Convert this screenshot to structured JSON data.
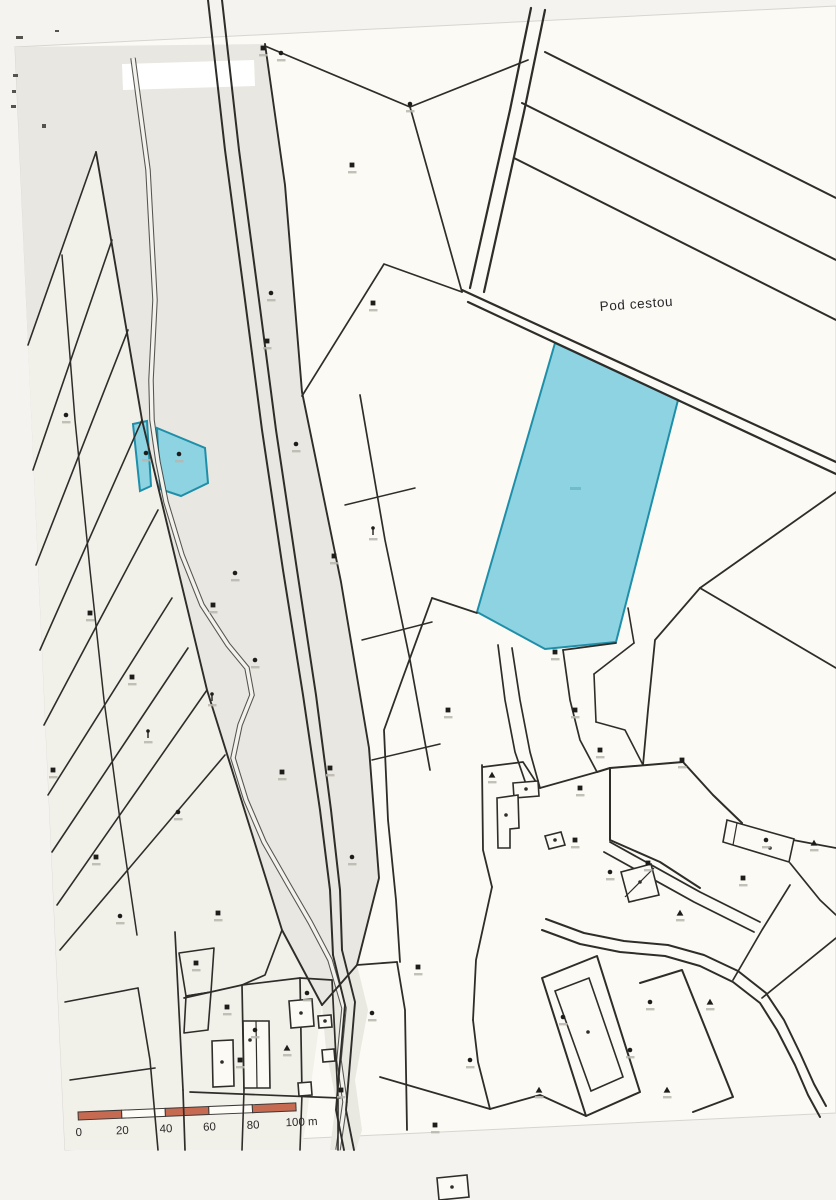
{
  "page": {
    "background": "#f4f3ef",
    "paper_color": "#fbfaf4",
    "paper_edge_color": "#d6d5cf",
    "paper_outline": "M15,47 L836,6 L836,1113 L65,1150 Z"
  },
  "labels": {
    "area_name": "Pod cestou"
  },
  "scale_bar": {
    "labels": [
      "0",
      "20",
      "40",
      "60",
      "80"
    ],
    "end_label": "100 m",
    "segments": 5,
    "segment_px": 43.6,
    "bar_height": 8,
    "bar_color": "#c76a52",
    "alt_color": "#fdfcf7",
    "outline_color": "#3a3937",
    "x": 78,
    "y": 1112,
    "rotation": -2.4
  },
  "map": {
    "line_color": "#2e2d29",
    "highlight_color": "#8ed3e1",
    "highlight_stroke": "#1f8fa9",
    "stream_edge": "#3a3a36",
    "stream_core": "#f3f2ec",
    "regions": [
      {
        "name": "shaded-corridor",
        "fill": "#e8e7e1",
        "d": "M15,47 L265,44 L285,185 L302,392 L341,582 L369,748 L379,878 L357,965 L322,1005 L282,930 L207,690 L142,420 L96,152 L28,345 Z"
      },
      {
        "name": "shaded-left-strips",
        "fill": "#f1f0e9",
        "d": "M28,345 L96,152 L142,420 L207,690 L282,930 L322,1005 L302,1150 L65,1150 Z"
      },
      {
        "name": "shaded-lower-corridor",
        "fill": "#e9e8e1",
        "d": "M322,1005 L357,965 L368,1010 L355,1080 L362,1130 L356,1150 L330,1150 L336,1100 L326,1050 Z"
      },
      {
        "name": "whiteout-patch",
        "fill": "#ffffff",
        "d": "M122,64 L254,60 L255,86 L123,90 Z"
      }
    ],
    "highlight_parcels": [
      {
        "name": "highlighted-parcel-large",
        "d": "M555,343 L678,400 L616,642 L545,649 L477,612 Z"
      },
      {
        "name": "highlighted-parcel-small-left",
        "d": "M133,424 L147,421 L151,486 L140,491 Z"
      },
      {
        "name": "highlighted-parcel-small-right",
        "d": "M157,428 L205,448 L208,483 L181,496 L160,489 Z"
      }
    ],
    "stream_path": "M133,58 L148,170 L155,300 L151,380 L152,420 L158,462 L166,502 L182,555 L202,605 L228,645 L247,668 L252,695 L240,725 L233,758 L246,800 L264,842 L288,884 L310,922 L330,960 L344,1008 L339,1060 L345,1102 L338,1150",
    "lines": [
      {
        "d": "M545,52 L836,198",
        "w": 2
      },
      {
        "d": "M522,103 L836,260",
        "w": 2
      },
      {
        "d": "M514,158 L836,320",
        "w": 2
      },
      {
        "d": "M531,8 L510,110 L470,288",
        "w": 2.2
      },
      {
        "d": "M545,10 L524,112 L484,292",
        "w": 2.2
      },
      {
        "d": "M462,290 L836,462",
        "w": 2.2
      },
      {
        "d": "M468,302 L836,474",
        "w": 2.2
      },
      {
        "d": "M265,46 L410,107",
        "w": 1.7
      },
      {
        "d": "M410,107 L462,292",
        "w": 1.7
      },
      {
        "d": "M410,107 L528,60",
        "w": 1.7
      },
      {
        "d": "M265,44 L285,185 L302,392 L341,582 L369,748 L379,878 L357,965 L322,1005",
        "w": 1.9
      },
      {
        "d": "M96,152 L142,420 L207,690 L282,930 L322,1005",
        "w": 1.9
      },
      {
        "d": "M96,152 L28,345",
        "w": 1.6
      },
      {
        "d": "M112,240 L33,470",
        "w": 1.6
      },
      {
        "d": "M128,330 L36,565",
        "w": 1.6
      },
      {
        "d": "M142,420 L40,650",
        "w": 1.6
      },
      {
        "d": "M158,510 L44,725",
        "w": 1.6
      },
      {
        "d": "M172,598 L48,795",
        "w": 1.6
      },
      {
        "d": "M188,648 L52,852",
        "w": 1.6
      },
      {
        "d": "M207,690 L57,905",
        "w": 1.6
      },
      {
        "d": "M225,755 L60,950",
        "w": 1.6
      },
      {
        "d": "M62,255 L75,420 L90,570 L104,700 L120,820 L137,935",
        "w": 1.5
      },
      {
        "d": "M208,0 L225,150 L245,300 L262,430 L283,570 L303,695 L320,810 L330,890 L333,955",
        "w": 2
      },
      {
        "d": "M222,0 L239,150 L259,300 L276,430 L297,570 L316,695 L331,810 L340,890 L342,950",
        "w": 2
      },
      {
        "d": "M302,396 L384,264 L462,292",
        "w": 1.7
      },
      {
        "d": "M360,395 L385,540 L410,660 L430,770",
        "w": 1.7
      },
      {
        "d": "M345,505 L415,488",
        "w": 1.5
      },
      {
        "d": "M362,640 L432,622",
        "w": 1.5
      },
      {
        "d": "M372,760 L440,744",
        "w": 1.5
      },
      {
        "d": "M432,598 L402,680 L384,730 L388,820 L396,900 L400,962",
        "w": 1.8
      },
      {
        "d": "M477,613 L432,598",
        "w": 1.8
      },
      {
        "d": "M616,643 L563,650",
        "w": 1.8
      },
      {
        "d": "M498,645 L505,700 L515,752 L528,790",
        "w": 1.7
      },
      {
        "d": "M512,648 L520,700 L530,752 L540,788",
        "w": 1.7
      },
      {
        "d": "M563,650 L570,700 L580,740 L597,772",
        "w": 1.7
      },
      {
        "d": "M628,608 L634,643",
        "w": 1.6
      },
      {
        "d": "M634,643 L594,674",
        "w": 1.6
      },
      {
        "d": "M594,674 L596,722",
        "w": 1.6
      },
      {
        "d": "M596,722 L625,730 L643,765",
        "w": 1.6
      },
      {
        "d": "M836,492 L700,588",
        "w": 1.8
      },
      {
        "d": "M700,588 L836,668",
        "w": 1.8
      },
      {
        "d": "M700,588 L655,640 L648,710 L643,765",
        "w": 1.8
      },
      {
        "d": "M482,765 L483,850 L492,887",
        "w": 1.8
      },
      {
        "d": "M492,887 L476,960 L473,1020",
        "w": 1.8
      },
      {
        "d": "M473,1020 L478,1062 L490,1109",
        "w": 1.8
      },
      {
        "d": "M483,767 L523,762 L540,788",
        "w": 1.7
      },
      {
        "d": "M540,788 L597,772",
        "w": 1.7
      },
      {
        "d": "M597,772 L610,768 L683,762",
        "w": 2
      },
      {
        "d": "M683,762 L713,795 L742,823",
        "w": 2
      },
      {
        "d": "M610,768 L610,840",
        "w": 2
      },
      {
        "d": "M610,840 L660,862 L700,888",
        "w": 2
      },
      {
        "d": "M610,842 L700,892 L760,922",
        "w": 1.8
      },
      {
        "d": "M604,852 L694,902 L754,932",
        "w": 1.8
      },
      {
        "d": "M793,840 L836,848",
        "w": 1.7
      },
      {
        "d": "M790,863 L820,900 L836,915",
        "w": 1.7
      },
      {
        "d": "M762,998 L836,938",
        "w": 1.7
      },
      {
        "d": "M733,980 L762,930 L790,885",
        "w": 1.7
      },
      {
        "d": "M542,930 L580,944 L620,952 L665,956 L700,966 L733,982 L760,1003 L777,1030 L795,1065 L808,1095 L820,1117",
        "w": 2
      },
      {
        "d": "M546,919 L584,933 L624,941 L668,945 L704,955 L738,971 L766,993 L784,1020 L800,1053 L814,1084 L826,1106",
        "w": 2
      },
      {
        "d": "M542,978 L597,956 L640,1092 L586,1116 Z",
        "w": 2
      },
      {
        "d": "M640,983 L682,970 L733,1097 L693,1112",
        "w": 2
      },
      {
        "d": "M397,962 L405,1010 L407,1130",
        "w": 1.8
      },
      {
        "d": "M380,1077 L490,1109",
        "w": 1.8
      },
      {
        "d": "M490,1109 L540,1095 L586,1116",
        "w": 1.8
      },
      {
        "d": "M357,965 L397,962",
        "w": 1.8
      },
      {
        "d": "M333,955 L345,1005 L340,1062 L336,1110 L344,1150",
        "w": 1.9
      },
      {
        "d": "M342,950 L355,1002 L350,1062 L346,1110 L354,1150",
        "w": 1.9
      },
      {
        "d": "M175,932 L183,1090",
        "w": 1.7
      },
      {
        "d": "M183,1090 L185,1150",
        "w": 1.7
      },
      {
        "d": "M184,998 L242,985 L300,978 L332,980",
        "w": 1.7
      },
      {
        "d": "M190,1092 L340,1098",
        "w": 1.7
      },
      {
        "d": "M242,985 L244,1090",
        "w": 1.7
      },
      {
        "d": "M300,978 L302,1094",
        "w": 1.7
      },
      {
        "d": "M332,980 L338,1098",
        "w": 1.7
      },
      {
        "d": "M244,1090 L242,1150",
        "w": 1.6
      },
      {
        "d": "M302,1094 L300,1150",
        "w": 1.6
      },
      {
        "d": "M338,1098 L338,1150",
        "w": 1.6
      },
      {
        "d": "M65,1002 L138,988",
        "w": 1.6
      },
      {
        "d": "M138,988 L150,1060 L158,1150",
        "w": 1.6
      },
      {
        "d": "M70,1080 L155,1068",
        "w": 1.6
      },
      {
        "d": "M179,953 L214,948 L211,992 L186,996 Z",
        "w": 1.6
      },
      {
        "d": "M186,996 L211,992 L208,1030 L184,1033 Z",
        "w": 1.6
      },
      {
        "d": "M282,930 L265,975 L242,985",
        "w": 1.7
      }
    ],
    "buildings": [
      {
        "d": "M513,783 L538,781 L539,796 L514,798 Z",
        "dot": [
          526,
          789
        ]
      },
      {
        "d": "M497,798 L518,795 L519,828 L510,829 L510,848 L498,848 Z",
        "dot": [
          506,
          815
        ]
      },
      {
        "d": "M545,836 L561,832 L565,845 L549,849 Z",
        "dot": [
          555,
          840
        ]
      },
      {
        "d": "M727,820 L794,839 L789,862 L723,842 Z",
        "dot": [
          770,
          848
        ],
        "div": "M737,823 L733,845"
      },
      {
        "d": "M621,872 L651,864 L659,895 L629,902 Z",
        "dot": [
          640,
          882
        ],
        "div": "M625,897 L654,868"
      },
      {
        "d": "M243,1021 L269,1021 L270,1088 L244,1088 Z",
        "dot": [
          250,
          1040
        ],
        "div": "M256,1021 L257,1088"
      },
      {
        "d": "M212,1041 L233,1040 L234,1086 L213,1087 Z",
        "dot": [
          222,
          1062
        ]
      },
      {
        "d": "M289,1001 L312,999 L314,1026 L291,1028 Z",
        "dot": [
          301,
          1013
        ]
      },
      {
        "d": "M318,1016 L331,1015 L332,1027 L319,1028 Z",
        "dot": [
          325,
          1021
        ]
      },
      {
        "d": "M322,1050 L334,1049 L335,1061 L323,1062 Z"
      },
      {
        "d": "M298,1083 L311,1082 L312,1095 L299,1096 Z"
      },
      {
        "d": "M555,991 L589,978 L623,1077 L591,1091 Z",
        "dot": [
          588,
          1032
        ]
      },
      {
        "d": "M437,1178 L467,1175 L469,1197 L439,1200 Z",
        "dot": [
          452,
          1187
        ]
      }
    ],
    "symbols": [
      [
        263,
        48,
        1
      ],
      [
        281,
        53,
        0
      ],
      [
        352,
        165,
        1
      ],
      [
        410,
        104,
        0
      ],
      [
        373,
        303,
        1
      ],
      [
        271,
        293,
        0
      ],
      [
        267,
        341,
        1
      ],
      [
        296,
        444,
        0
      ],
      [
        66,
        415,
        0
      ],
      [
        90,
        613,
        1
      ],
      [
        132,
        677,
        1
      ],
      [
        148,
        735,
        3
      ],
      [
        53,
        770,
        1
      ],
      [
        235,
        573,
        0
      ],
      [
        213,
        605,
        1
      ],
      [
        212,
        698,
        3
      ],
      [
        282,
        772,
        1
      ],
      [
        178,
        812,
        0
      ],
      [
        146,
        453,
        0
      ],
      [
        179,
        454,
        0
      ],
      [
        96,
        857,
        1
      ],
      [
        120,
        916,
        0
      ],
      [
        218,
        913,
        1
      ],
      [
        330,
        768,
        1
      ],
      [
        352,
        857,
        0
      ],
      [
        255,
        660,
        0
      ],
      [
        373,
        532,
        3
      ],
      [
        334,
        556,
        1
      ],
      [
        448,
        710,
        1
      ],
      [
        555,
        652,
        1
      ],
      [
        575,
        710,
        1
      ],
      [
        492,
        775,
        2
      ],
      [
        580,
        788,
        1
      ],
      [
        600,
        750,
        1
      ],
      [
        575,
        840,
        1
      ],
      [
        610,
        872,
        0
      ],
      [
        648,
        863,
        1
      ],
      [
        743,
        878,
        1
      ],
      [
        766,
        840,
        0
      ],
      [
        682,
        760,
        1
      ],
      [
        680,
        913,
        2
      ],
      [
        814,
        843,
        2
      ],
      [
        196,
        963,
        1
      ],
      [
        227,
        1007,
        1
      ],
      [
        240,
        1060,
        1
      ],
      [
        255,
        1030,
        0
      ],
      [
        307,
        993,
        0
      ],
      [
        287,
        1048,
        2
      ],
      [
        341,
        1090,
        1
      ],
      [
        418,
        967,
        1
      ],
      [
        372,
        1013,
        0
      ],
      [
        539,
        1090,
        2
      ],
      [
        650,
        1002,
        0
      ],
      [
        630,
        1050,
        0
      ],
      [
        667,
        1090,
        2
      ],
      [
        710,
        1002,
        2
      ],
      [
        563,
        1017,
        0
      ],
      [
        470,
        1060,
        0
      ],
      [
        435,
        1125,
        1
      ]
    ],
    "artifacts": [
      [
        16,
        36,
        7,
        3
      ],
      [
        13,
        74,
        5,
        3
      ],
      [
        12,
        90,
        4,
        3
      ],
      [
        11,
        105,
        5,
        3
      ],
      [
        42,
        124,
        4,
        4
      ],
      [
        55,
        30,
        4,
        2
      ]
    ],
    "faint_parcel_number": {
      "x": 570,
      "y": 487,
      "w": 11,
      "h": 3,
      "color": "#5aa7b8"
    }
  },
  "label_style": {
    "area_name_x": 600,
    "area_name_y": 311,
    "area_name_rotation": -4
  }
}
